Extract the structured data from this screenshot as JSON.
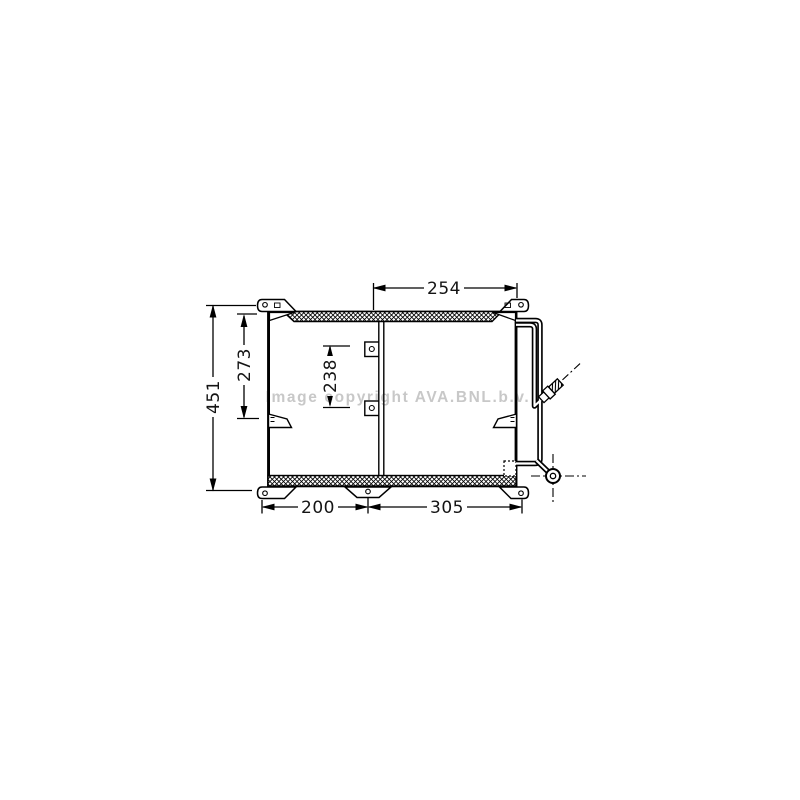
{
  "watermark": {
    "text": "Image copyright AVA.BNL.b.v.",
    "color": "#c8c8c8"
  },
  "diagram": {
    "description": "technical line drawing of a condenser core with header bars, mounting brackets and refrigerant pipes",
    "dimensions": {
      "overall_height": "451",
      "core_left_height": "273",
      "core_inner_height": "238",
      "top_width": "254",
      "bottom_width_left": "200",
      "bottom_width_right": "305"
    },
    "colors": {
      "line": "#000000",
      "background": "#ffffff",
      "watermark": "#c8c8c8"
    }
  }
}
